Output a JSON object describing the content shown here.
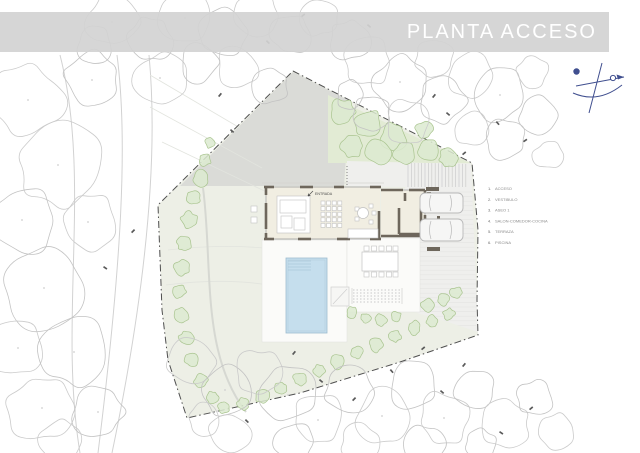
{
  "title": "PLANTA ACCESO",
  "legend": {
    "x_num": 488,
    "x_label": 495,
    "y0": 190,
    "dy": 10.8,
    "items": [
      {
        "num": "1.",
        "label": "ACCESO"
      },
      {
        "num": "2.",
        "label": "VESTIBULO"
      },
      {
        "num": "3.",
        "label": "ASEO 1"
      },
      {
        "num": "4.",
        "label": "SALON-COMEDOR-COCINA"
      },
      {
        "num": "5.",
        "label": "TERRAZA"
      },
      {
        "num": "6.",
        "label": "PISCINA"
      }
    ]
  },
  "house": {
    "entrance_label": "ENTRADA"
  },
  "colors": {
    "header_band": "rgba(210,210,210,0.92)",
    "title_text": "#ffffff",
    "paper": "#ffffff",
    "boundary": "#4f4f4f",
    "site_fill": "#edefe6",
    "driveway": "#dadbd7",
    "green_area": "#e2ebd4",
    "shrub_stroke": "#a9c48f",
    "shrub_fill": "#dcead0",
    "tree_stroke": "#cbcbcb",
    "wall": "#6e675c",
    "glazing": "#9a9a9a",
    "floor": "#f1eee2",
    "pool_fill": "#c5deed",
    "pool_edge": "#9dbccf",
    "parking_fill": "#efefed",
    "stripe": "#dedede",
    "terrace": "#fbfbf9",
    "furniture": "#c2c2c2",
    "car": "#b8b8b8",
    "legend_text": "#8b8b8b",
    "compass": "#404f8f",
    "label_text": "#4a4a4a"
  },
  "geometry": {
    "boundary": [
      [
        293,
        71
      ],
      [
        472,
        163
      ],
      [
        478,
        230
      ],
      [
        477,
        300
      ],
      [
        478,
        335
      ],
      [
        400,
        362
      ],
      [
        300,
        393
      ],
      [
        187,
        418
      ],
      [
        168,
        360
      ],
      [
        162,
        310
      ],
      [
        158,
        205
      ],
      [
        293,
        71
      ]
    ],
    "driveway": [
      [
        293,
        72
      ],
      [
        350,
        101
      ],
      [
        344,
        186
      ],
      [
        180,
        186
      ]
    ],
    "green_triangle": [
      [
        328,
        95
      ],
      [
        470,
        163
      ],
      [
        328,
        163
      ]
    ],
    "parking": [
      [
        347,
        161
      ],
      [
        471,
        164
      ],
      [
        478,
        332
      ],
      [
        448,
        322
      ],
      [
        420,
        314
      ],
      [
        405,
        308
      ],
      [
        405,
        187
      ],
      [
        347,
        186
      ]
    ],
    "terraces": [
      [
        262,
        240,
        85,
        102
      ],
      [
        347,
        238,
        73,
        74
      ]
    ],
    "pool": {
      "x": 286,
      "y": 258,
      "w": 41,
      "h": 75
    },
    "roads": [
      "M117,55 C128,140 122,260 98,453",
      "M149,55 C158,150 148,280 112,453",
      "M60,55 C92,180 58,320 80,453"
    ],
    "contours": [
      "M150,75 L240,128",
      "M150,107 L262,168",
      "M162,142 L277,197",
      "M168,250 C220,244 260,246 290,252",
      "M166,285 C220,278 262,282 292,290"
    ],
    "garden_path": "M203,188 C210,240 206,300 218,350 C224,375 233,395 246,412",
    "walls_glaze": [
      [
        265,
        187,
        381,
        187
      ],
      [
        265,
        239,
        381,
        239
      ],
      [
        266,
        187,
        266,
        239
      ],
      [
        381,
        190,
        425,
        190
      ],
      [
        425,
        190,
        425,
        236
      ],
      [
        381,
        236,
        425,
        236
      ]
    ],
    "walls_dark": [
      [
        264,
        187,
        274,
        187
      ],
      [
        300,
        187,
        313,
        187
      ],
      [
        334,
        187,
        344,
        187
      ],
      [
        370,
        187,
        381,
        187
      ],
      [
        264,
        239,
        274,
        239
      ],
      [
        298,
        239,
        311,
        239
      ],
      [
        337,
        239,
        350,
        239
      ],
      [
        370,
        239,
        381,
        239
      ],
      [
        266,
        186,
        266,
        195
      ],
      [
        266,
        203,
        266,
        229
      ],
      [
        266,
        233,
        266,
        240
      ],
      [
        379,
        211,
        379,
        239
      ],
      [
        381,
        190,
        403,
        190
      ],
      [
        409,
        190,
        425,
        190
      ],
      [
        425,
        190,
        425,
        201
      ],
      [
        425,
        215,
        425,
        236
      ],
      [
        381,
        236,
        425,
        236
      ],
      [
        399,
        208,
        399,
        234
      ],
      [
        399,
        234,
        421,
        234
      ],
      [
        421,
        208,
        421,
        234
      ],
      [
        405,
        193,
        405,
        201
      ]
    ],
    "floors": [
      [
        266,
        187,
        114,
        52
      ],
      [
        381,
        190,
        44,
        46
      ]
    ],
    "roofline": [
      262,
      183,
      384,
      183
    ],
    "dark_stubs": [
      [
        426,
        187,
        13,
        4
      ],
      [
        427,
        247,
        13,
        4
      ],
      [
        427,
        192,
        4,
        6
      ],
      [
        437,
        216,
        3,
        3
      ]
    ],
    "cars": [
      {
        "x": 420,
        "y": 193,
        "w": 43,
        "h": 20
      },
      {
        "x": 420,
        "y": 219,
        "w": 43,
        "h": 22
      }
    ],
    "sofa": {
      "outer": [
        277,
        196,
        33,
        37
      ],
      "parts": [
        [
          280,
          200,
          26,
          13
        ],
        [
          281,
          216,
          11,
          12
        ],
        [
          294,
          218,
          11,
          12
        ]
      ]
    },
    "dining_grid": {
      "x0": 321,
      "y0": 201,
      "cols": 4,
      "rows": 5,
      "step": 5.6,
      "size": 4
    },
    "round_table": {
      "cx": 363,
      "cy": 213,
      "r": 5.5,
      "chairs": [
        [
          355,
          207
        ],
        [
          355,
          217
        ],
        [
          369,
          204
        ],
        [
          369,
          220
        ],
        [
          372,
          211
        ]
      ]
    },
    "kitchen": [
      348,
      229,
      30,
      9
    ],
    "porch_chairs": [
      [
        251,
        206
      ],
      [
        251,
        217
      ]
    ],
    "outdoor_table": {
      "rect": [
        362,
        252,
        36,
        19
      ],
      "chairs_y": [
        246,
        272
      ],
      "chairs_x": [
        364,
        371.5,
        379,
        386.5,
        393
      ]
    },
    "steps": {
      "rails": [
        [
          352,
          288,
          352,
          304
        ],
        [
          402,
          288,
          402,
          304
        ]
      ],
      "treads_y": [
        290,
        293,
        296,
        299,
        302
      ],
      "x1": 353,
      "x2": 401
    },
    "pad": {
      "rect": [
        331,
        287,
        18,
        19
      ],
      "diag": [
        333,
        304,
        347,
        289
      ]
    },
    "connector_dots": [
      347,
      166,
      347,
      186
    ],
    "entrance_xy": [
      315,
      197
    ],
    "trees": [
      [
        28,
        100,
        36
      ],
      [
        92,
        80,
        28
      ],
      [
        58,
        165,
        42
      ],
      [
        22,
        220,
        34
      ],
      [
        88,
        222,
        28
      ],
      [
        44,
        288,
        40
      ],
      [
        18,
        348,
        28
      ],
      [
        74,
        352,
        34
      ],
      [
        42,
        408,
        34
      ],
      [
        98,
        412,
        26
      ],
      [
        60,
        440,
        20
      ],
      [
        95,
        45,
        18
      ],
      [
        112,
        22,
        26
      ],
      [
        150,
        40,
        22
      ],
      [
        185,
        18,
        26
      ],
      [
        222,
        32,
        24
      ],
      [
        258,
        16,
        22
      ],
      [
        290,
        34,
        20
      ],
      [
        320,
        18,
        18
      ],
      [
        350,
        40,
        20
      ],
      [
        160,
        78,
        26
      ],
      [
        200,
        62,
        20
      ],
      [
        238,
        68,
        22
      ],
      [
        270,
        86,
        18
      ],
      [
        368,
        62,
        24
      ],
      [
        400,
        82,
        26
      ],
      [
        435,
        60,
        20
      ],
      [
        372,
        112,
        18
      ],
      [
        408,
        122,
        22
      ],
      [
        442,
        100,
        24
      ],
      [
        470,
        75,
        22
      ],
      [
        500,
        95,
        26
      ],
      [
        472,
        130,
        18
      ],
      [
        505,
        140,
        20
      ],
      [
        532,
        72,
        16
      ],
      [
        538,
        115,
        18
      ],
      [
        548,
        155,
        14
      ],
      [
        350,
        95,
        14
      ],
      [
        192,
        362,
        24
      ],
      [
        225,
        390,
        26
      ],
      [
        258,
        372,
        22
      ],
      [
        288,
        395,
        28
      ],
      [
        318,
        420,
        26
      ],
      [
        350,
        392,
        24
      ],
      [
        382,
        416,
        26
      ],
      [
        412,
        386,
        24
      ],
      [
        444,
        418,
        26
      ],
      [
        475,
        390,
        20
      ],
      [
        505,
        424,
        24
      ],
      [
        535,
        398,
        18
      ],
      [
        558,
        432,
        18
      ],
      [
        425,
        445,
        20
      ],
      [
        360,
        445,
        20
      ],
      [
        295,
        442,
        20
      ],
      [
        230,
        432,
        20
      ],
      [
        480,
        445,
        16
      ],
      [
        205,
        420,
        16
      ]
    ],
    "shrubs": [
      [
        342,
        112,
        13
      ],
      [
        368,
        124,
        15
      ],
      [
        394,
        136,
        13
      ],
      [
        352,
        146,
        11
      ],
      [
        378,
        152,
        12
      ],
      [
        404,
        154,
        11
      ],
      [
        428,
        150,
        10
      ],
      [
        424,
        130,
        9
      ],
      [
        448,
        158,
        9
      ],
      [
        205,
        160,
        6
      ],
      [
        210,
        143,
        5
      ],
      [
        201,
        178,
        8
      ],
      [
        194,
        198,
        7
      ],
      [
        189,
        220,
        8
      ],
      [
        184,
        244,
        7
      ],
      [
        181,
        268,
        8
      ],
      [
        179,
        292,
        7
      ],
      [
        181,
        315,
        8
      ],
      [
        186,
        338,
        7
      ],
      [
        192,
        360,
        7
      ],
      [
        201,
        380,
        7
      ],
      [
        212,
        397,
        6
      ],
      [
        224,
        408,
        6
      ],
      [
        243,
        404,
        6
      ],
      [
        262,
        396,
        7
      ],
      [
        281,
        388,
        6
      ],
      [
        300,
        379,
        7
      ],
      [
        319,
        371,
        6
      ],
      [
        338,
        362,
        7
      ],
      [
        357,
        353,
        6
      ],
      [
        376,
        345,
        7
      ],
      [
        395,
        336,
        6
      ],
      [
        414,
        328,
        7
      ],
      [
        432,
        321,
        6
      ],
      [
        449,
        314,
        6
      ],
      [
        352,
        312,
        6
      ],
      [
        366,
        318,
        5
      ],
      [
        381,
        320,
        6
      ],
      [
        396,
        316,
        5
      ],
      [
        428,
        305,
        7
      ],
      [
        443,
        300,
        6
      ],
      [
        456,
        293,
        6
      ]
    ],
    "tags": [
      [
        218,
        96,
        -50
      ],
      [
        231,
        129,
        40
      ],
      [
        131,
        232,
        -45
      ],
      [
        104,
        266,
        35
      ],
      [
        432,
        97,
        -50
      ],
      [
        447,
        112,
        40
      ],
      [
        462,
        154,
        -40
      ],
      [
        497,
        121,
        50
      ],
      [
        523,
        141,
        -35
      ],
      [
        368,
        24,
        40
      ],
      [
        301,
        16,
        -40
      ],
      [
        267,
        40,
        45
      ],
      [
        292,
        354,
        -50
      ],
      [
        320,
        379,
        40
      ],
      [
        352,
        400,
        -45
      ],
      [
        391,
        369,
        50
      ],
      [
        421,
        349,
        -40
      ],
      [
        441,
        390,
        40
      ],
      [
        462,
        366,
        -50
      ],
      [
        500,
        431,
        35
      ],
      [
        529,
        409,
        -40
      ],
      [
        246,
        419,
        45
      ]
    ]
  }
}
